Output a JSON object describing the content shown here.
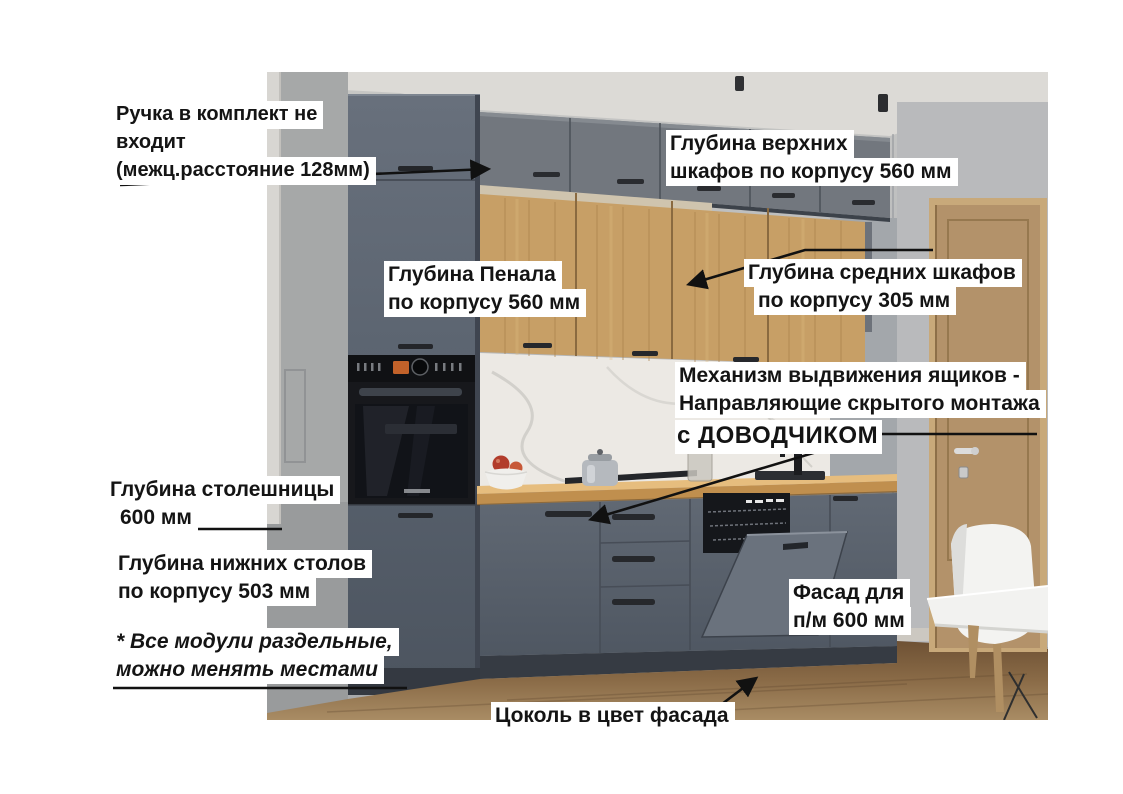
{
  "page": {
    "background": "#ffffff",
    "type": "annotated-kitchen-product-diagram"
  },
  "annotations": {
    "handle_note": {
      "lines": [
        "Ручка в комплект не",
        "входит",
        "(межц.расстояние 128мм)"
      ]
    },
    "upper_cabinet_depth": {
      "lines": [
        "Глубина верхних",
        "шкафов по корпусу 560 мм"
      ]
    },
    "tall_cabinet_depth": {
      "lines": [
        "Глубина Пенала",
        "по корпусу 560 мм"
      ]
    },
    "middle_cabinet_depth": {
      "lines": [
        "Глубина средних шкафов",
        "по корпусу 305 мм"
      ]
    },
    "drawer_mechanism": {
      "lines": [
        "Механизм выдвижения ящиков -",
        "Направляющие скрытого монтажа"
      ],
      "emphasis": "с ДОВОДЧИКОМ"
    },
    "countertop_depth": {
      "lines": [
        "Глубина столешницы",
        "600 мм"
      ]
    },
    "base_cabinet_depth": {
      "lines": [
        "Глубина нижних столов",
        "по корпусу 503 мм"
      ]
    },
    "modules_note": {
      "lines": [
        "* Все модули раздельные,",
        "можно менять местами"
      ]
    },
    "dishwasher_front": {
      "lines": [
        "Фасад для",
        "п/м 600 мм"
      ]
    },
    "plinth_note": {
      "lines": [
        "Цоколь в цвет фасада"
      ]
    }
  },
  "colors": {
    "annotation_bg": "#ffffff",
    "annotation_text": "#141414",
    "arrow": "#111111",
    "cabinet_grey": "#5c6470",
    "upper_cabinet_grey": "#72777e",
    "wood_front": "#c79f66",
    "countertop": "#c8995c",
    "marble_backsplash": "#ece9e4",
    "plinth": "#363b43",
    "floor": "#8a6b47",
    "room_door": "#b3926a",
    "wall": "#b4b6b8",
    "oven": "#17181c"
  }
}
